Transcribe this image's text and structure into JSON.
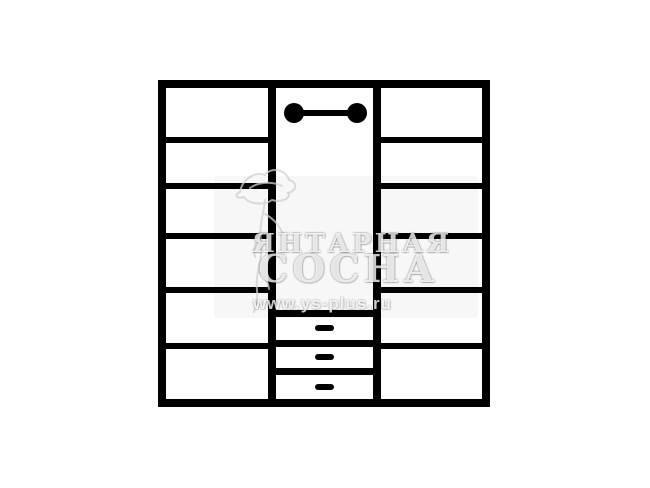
{
  "page": {
    "background_color": "#ffffff"
  },
  "diagram": {
    "type": "wardrobe-front-view-scheme",
    "line_color": "#000000",
    "left_column": {
      "compartments": 6,
      "shelves": 5
    },
    "middle_column": {
      "hanging_rod": true,
      "drawers": 3
    },
    "right_column": {
      "compartments": 6,
      "shelves": 5
    }
  },
  "watermark": {
    "color": "#d8d8d8",
    "logo": "pine-tree",
    "brand_line1": "ЯНТАРНАЯ",
    "brand_line2": "СОСНА",
    "url": "www.ys-plus.ru"
  }
}
